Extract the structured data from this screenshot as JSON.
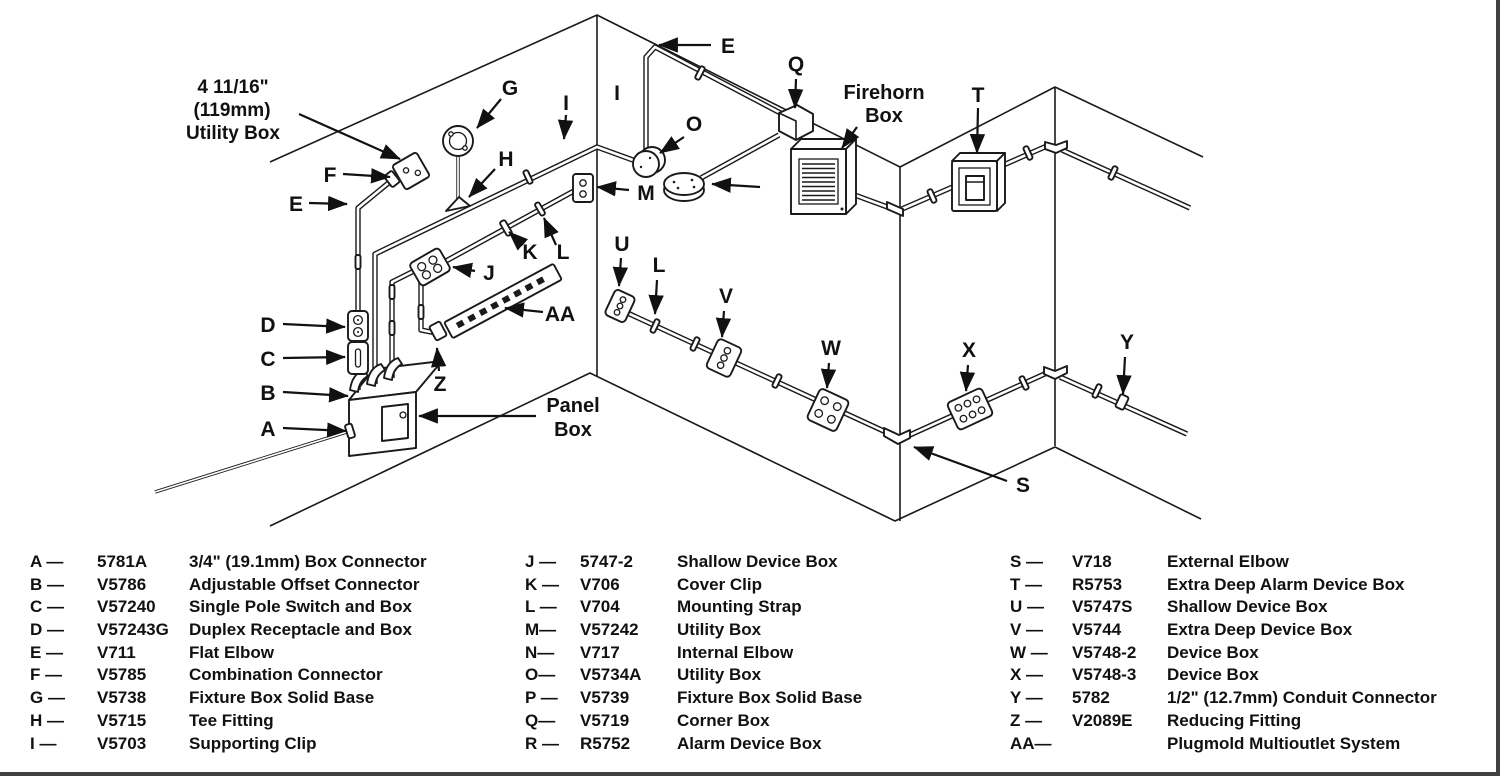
{
  "diagram": {
    "note": {
      "line1": "4 11/16\"",
      "line2": "(119mm)",
      "line3": "Utility Box"
    },
    "callouts": {
      "panel_line1": "Panel",
      "panel_line2": "Box",
      "firehorn_line1": "Firehorn",
      "firehorn_line2": "Box"
    },
    "letters": {
      "a": "A",
      "b": "B",
      "c": "C",
      "d": "D",
      "e_left": "E",
      "f": "F",
      "g": "G",
      "h": "H",
      "i_left": "I",
      "j": "J",
      "k": "K",
      "l_left": "L",
      "m": "M",
      "z": "Z",
      "aa": "AA",
      "e_top": "E",
      "i_mid": "I",
      "o": "O",
      "q": "Q",
      "t": "T",
      "u": "U",
      "l_mid": "L",
      "v": "V",
      "w": "W",
      "x": "X",
      "s": "S",
      "y": "Y"
    },
    "colors": {
      "ink": "#1a1a1a",
      "paper": "#ffffff"
    }
  },
  "legend": {
    "columns": [
      {
        "rows": [
          {
            "key": "A —",
            "part": "5781A",
            "desc": "3/4\" (19.1mm) Box Connector"
          },
          {
            "key": "B —",
            "part": "V5786",
            "desc": "Adjustable Offset Connector"
          },
          {
            "key": "C —",
            "part": "V57240",
            "desc": "Single Pole Switch and Box"
          },
          {
            "key": "D —",
            "part": "V57243G",
            "desc": "Duplex Receptacle and Box"
          },
          {
            "key": "E —",
            "part": "V711",
            "desc": "Flat Elbow"
          },
          {
            "key": "F —",
            "part": "V5785",
            "desc": "Combination Connector"
          },
          {
            "key": "G —",
            "part": "V5738",
            "desc": "Fixture Box Solid Base"
          },
          {
            "key": "H —",
            "part": "V5715",
            "desc": "Tee Fitting"
          },
          {
            "key": "I —",
            "part": "V5703",
            "desc": "Supporting Clip"
          }
        ]
      },
      {
        "rows": [
          {
            "key": "J —",
            "part": "5747-2",
            "desc": "Shallow Device Box"
          },
          {
            "key": "K —",
            "part": "V706",
            "desc": "Cover Clip"
          },
          {
            "key": "L —",
            "part": "V704",
            "desc": "Mounting Strap"
          },
          {
            "key": "M—",
            "part": "V57242",
            "desc": "Utility Box"
          },
          {
            "key": "N—",
            "part": "V717",
            "desc": "Internal Elbow"
          },
          {
            "key": "O—",
            "part": "V5734A",
            "desc": "Utility Box"
          },
          {
            "key": "P —",
            "part": "V5739",
            "desc": "Fixture Box Solid Base"
          },
          {
            "key": "Q—",
            "part": "V5719",
            "desc": "Corner Box"
          },
          {
            "key": "R —",
            "part": "R5752",
            "desc": "Alarm Device Box"
          }
        ]
      },
      {
        "rows": [
          {
            "key": "S —",
            "part": "V718",
            "desc": "External Elbow"
          },
          {
            "key": "T —",
            "part": "R5753",
            "desc": "Extra Deep Alarm Device Box"
          },
          {
            "key": "U —",
            "part": "V5747S",
            "desc": "Shallow Device Box"
          },
          {
            "key": "V —",
            "part": "V5744",
            "desc": "Extra Deep Device Box"
          },
          {
            "key": "W —",
            "part": "V5748-2",
            "desc": "Device Box"
          },
          {
            "key": "X —",
            "part": "V5748-3",
            "desc": "Device Box"
          },
          {
            "key": "Y —",
            "part": "5782",
            "desc": "1/2\" (12.7mm) Conduit Connector"
          },
          {
            "key": "Z —",
            "part": "V2089E",
            "desc": "Reducing Fitting"
          },
          {
            "key": "AA—",
            "part": "",
            "desc": "Plugmold Multioutlet System"
          }
        ]
      }
    ]
  }
}
